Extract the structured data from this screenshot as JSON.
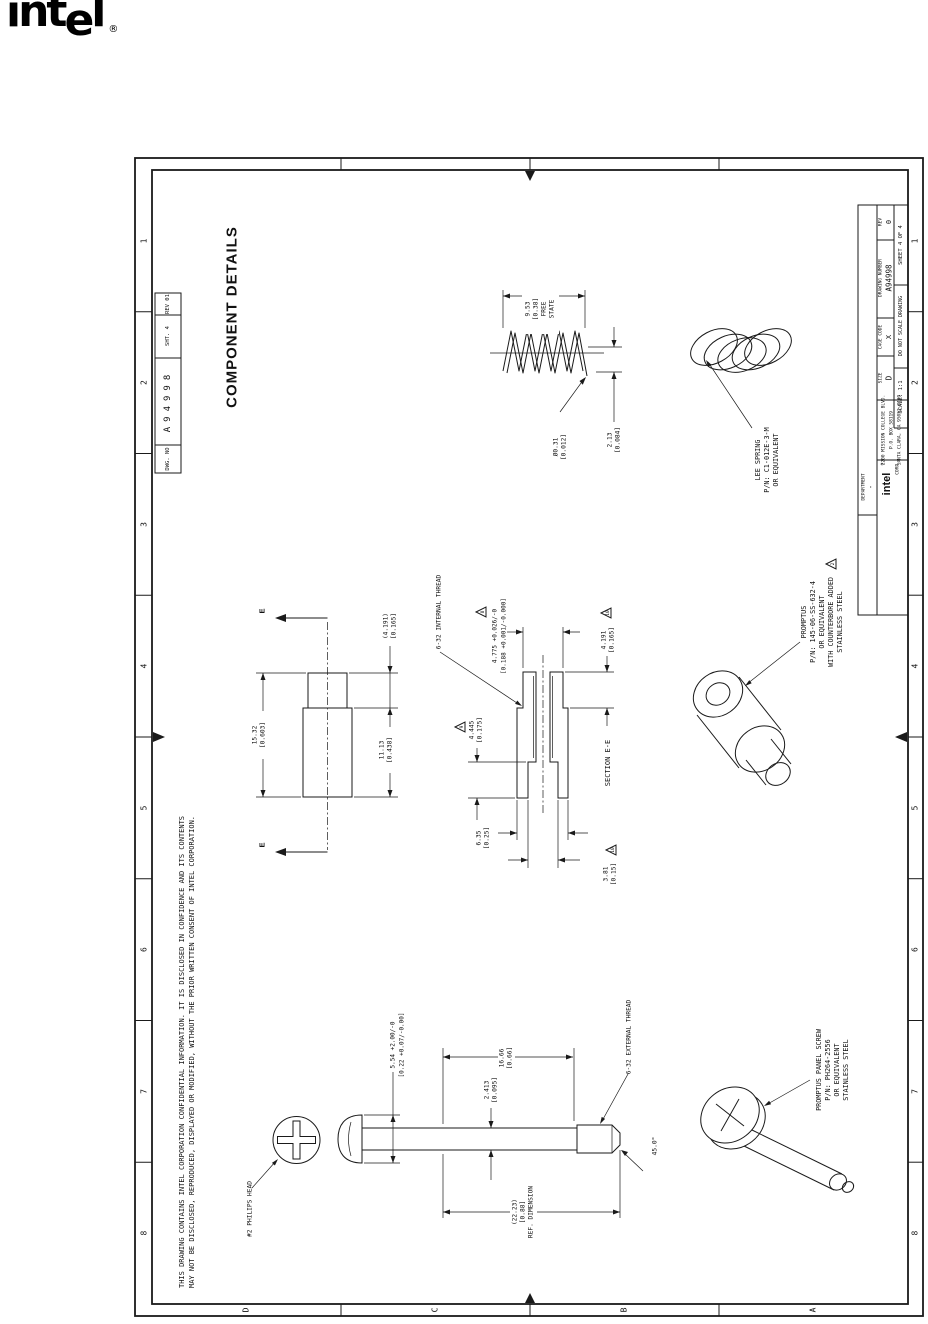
{
  "logo": {
    "part1": "int",
    "part2": "e",
    "part3": "l",
    "registered": "®"
  },
  "title": "COMPONENT DETAILS",
  "frame": {
    "zone_numbers": [
      "1",
      "2",
      "3",
      "4",
      "5",
      "6",
      "7",
      "8"
    ],
    "zone_letters": [
      "D",
      "C",
      "B",
      "A"
    ]
  },
  "notes": {
    "confidential_1": "THIS DRAWING CONTAINS INTEL CORPORATION CONFIDENTIAL INFORMATION. IT IS DISCLOSED IN CONFIDENCE AND ITS CONTENTS",
    "confidential_2": "MAY NOT BE DISCLOSED, REPRODUCED, DISPLAYED OR MODIFIED, WITHOUT THE PRIOR WRITTEN CONSENT OF INTEL CORPORATION."
  },
  "header_strip": {
    "dwg_no_label": "DWG. NO",
    "dwg_no": "A94998",
    "sheet": "SHT. 4",
    "rev": "REV 01"
  },
  "spring": {
    "free_len_1": "9.53",
    "free_len_2": "[0.38]",
    "free_len_3": "FREE",
    "free_len_4": "STATE",
    "wire_dia_1": "Ø0.31",
    "wire_dia_2": "[0.012]",
    "pitch_1": "2.13",
    "pitch_2": "[0.084]",
    "callout_1": "LEE SPRING",
    "callout_2": "P/N: C1-012E-3-M",
    "callout_3": "OR EQUIVALENT"
  },
  "standoff": {
    "thread_callout": "6-32 INTERNAL THREAD",
    "overall_1": "15.32",
    "overall_2": "[0.603]",
    "boss_ref_1": "(4.191)",
    "boss_ref_2": "[0.165]",
    "body_1": "11.13",
    "body_2": "[0.438]",
    "cut_label": "E",
    "section_label": "SECTION E-E",
    "press_dia_1": "4.775 +0.026/-0",
    "press_dia_2": "[0.188 +0.001/-0.000]",
    "press_flag": "8",
    "boss_len_1": "4.191",
    "boss_len_2": "[0.165]",
    "boss_len_flag": "10",
    "cbore_depth_1": "4.445",
    "cbore_depth_2": "[0.175]",
    "cbore_depth_flag": "9",
    "body_dia_1": "6.35",
    "body_dia_2": "[0.25]",
    "cbore_dia_1": "3.81",
    "cbore_dia_2": "[0.15]",
    "cbore_dia_flag": "10",
    "callout_1": "PROMPTUS",
    "callout_2": "P/N: 145-06-SS-632-4",
    "callout_3": "OR EQUIVALENT",
    "callout_4": "WITH COUNTERBORE ADDED",
    "callout_5": "STAINLESS STEEL",
    "callout_flag": "2"
  },
  "screw": {
    "head_callout": "#2 PHILIPS HEAD",
    "head_h_1": "5.54 +2.00/-0",
    "head_h_2": "[0.22 +0.07/-0.00]",
    "shank_dia_1": "2.413",
    "shank_dia_2": "[0.095]",
    "thread_len_1": "16.66",
    "thread_len_2": "[0.66]",
    "overall_1": "(22.23)",
    "overall_2": "[0.88]",
    "overall_3": "REF. DIMENSION",
    "thread_callout": "6-32 EXTERNAL THREAD",
    "chamfer": "45.0°",
    "callout_1": "PROMPTUS PANEL SCREW",
    "callout_2": "P/N: PH264-2556",
    "callout_3": "OR EQUIVALENT",
    "callout_4": "STAINLESS STEEL"
  },
  "title_block": {
    "department_label": "DEPARTMENT",
    "department_value": "-",
    "brand": "intel",
    "registered": "®",
    "company": "CORP.",
    "address_1": "2200 MISSION COLLEGE BLVD.",
    "address_2": "P.O. BOX 58119",
    "address_3": "SANTA CLARA, CA 95052-8119",
    "size_label": "SIZE",
    "size_value": "D",
    "cage_label": "CAGE CODE",
    "cage_value": "X",
    "dwg_label": "DRAWING NUMBER",
    "dwg_value": "A94998",
    "scale": "SCALE: 1:1",
    "no_scale": "DO NOT SCALE DRAWING",
    "sheet": "SHEET 4 OF 4",
    "rev_label": "REV",
    "rev_value": "0"
  }
}
